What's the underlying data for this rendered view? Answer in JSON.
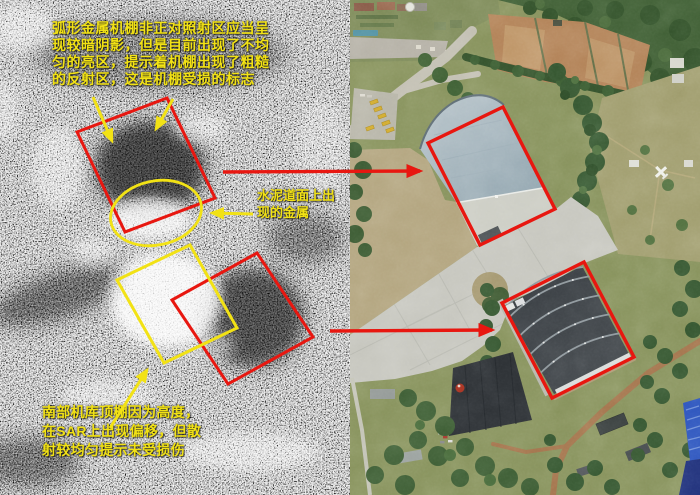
{
  "colors": {
    "annotation_yellow": "#f2e215",
    "annotation_red": "#e81710"
  },
  "sar_panel": {
    "top_note_lines": [
      "弧形金属机棚非正对照射区应当呈",
      "现较暗阴影，但是目前出现了不均",
      "匀的亮区，提示着机棚出现了粗糙",
      "的反射区，这是机棚受损的标志"
    ],
    "metal_note_lines": [
      "水泥道面上出",
      "现的金属"
    ],
    "south_note_lines": [
      "南部机库顶棚因为高度，",
      "在SAR上出现偏移，但散",
      "射较均匀提示未受损伤"
    ]
  }
}
